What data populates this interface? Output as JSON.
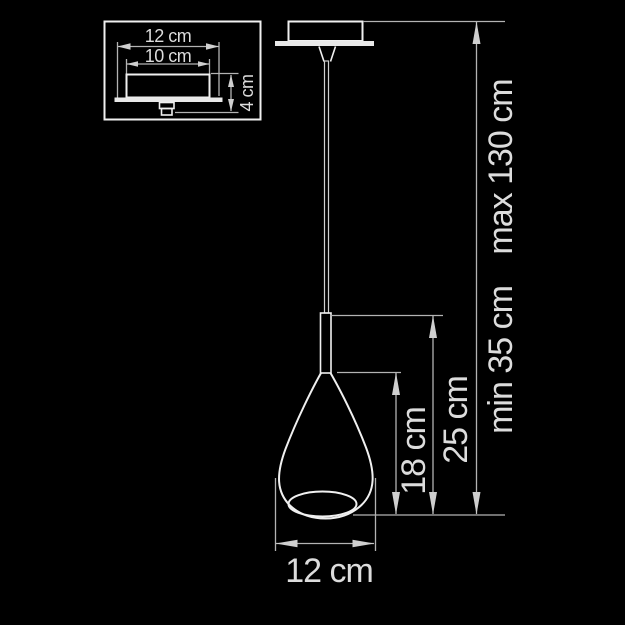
{
  "colors": {
    "background": "#000000",
    "line": "#f0f0f0",
    "dim_line": "#b3b3b3",
    "text": "#dcdcdc"
  },
  "inset": {
    "labels": {
      "plate_width": "12 cm",
      "body_width": "10 cm",
      "height": "4 cm"
    }
  },
  "main": {
    "labels": {
      "shade_height": "18 cm",
      "fixture_height": "25 cm",
      "min_overall": "min 35 cm",
      "max_overall": "max 130 cm",
      "shade_width": "12 cm"
    }
  }
}
